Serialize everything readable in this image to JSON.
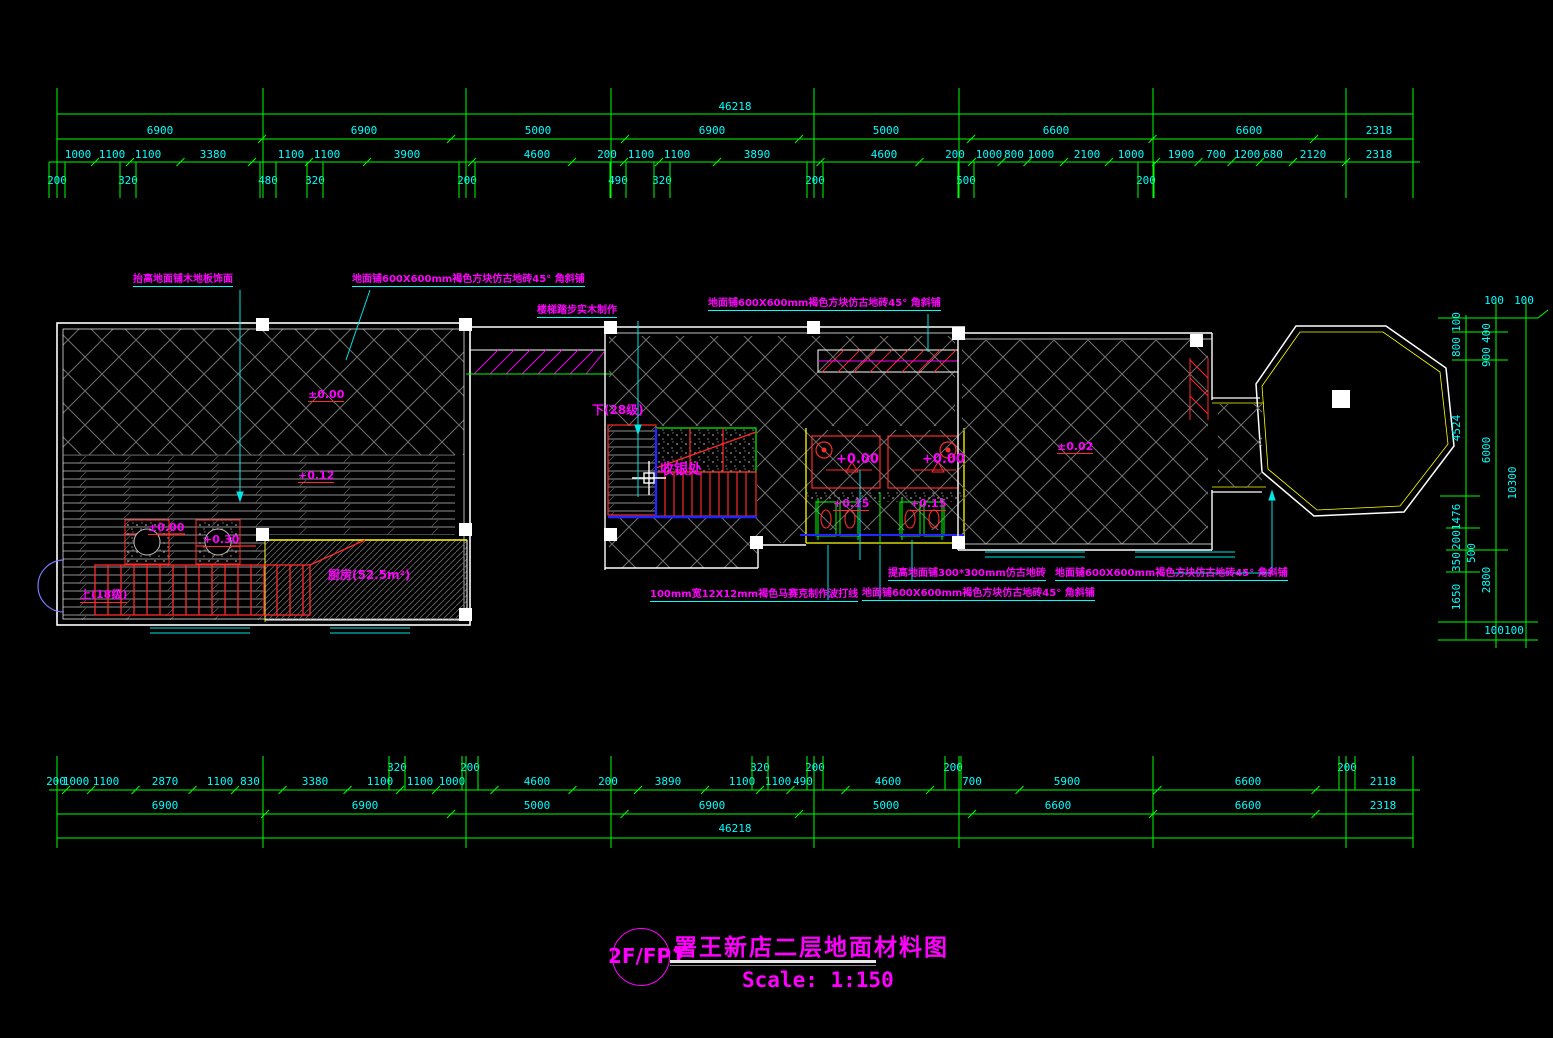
{
  "colors": {
    "background": "#000000",
    "dim_line": "#00ff00",
    "dim_text": "#00ffff",
    "annotation_text": "#ff00ff",
    "leader": "#00ffff",
    "wall": "#ffffff",
    "accent_red": "#ff0000",
    "accent_yellow": "#ffff00",
    "accent_blue": "#0000ff"
  },
  "top_dims": {
    "overall": {
      "t": "46218",
      "x": 735,
      "y": 110
    },
    "major": {
      "y": 134,
      "labels": [
        [
          "6900",
          160
        ],
        [
          "6900",
          364
        ],
        [
          "5000",
          538
        ],
        [
          "6900",
          712
        ],
        [
          "5000",
          886
        ],
        [
          "6600",
          1056
        ],
        [
          "6600",
          1249
        ],
        [
          "2318",
          1379
        ]
      ]
    },
    "detail": {
      "y": 158,
      "labels": [
        [
          "1000",
          78
        ],
        [
          "1100",
          112
        ],
        [
          "1100",
          148
        ],
        [
          "3380",
          213
        ],
        [
          "1100",
          291
        ],
        [
          "1100",
          327
        ],
        [
          "3900",
          407
        ],
        [
          "4600",
          537
        ],
        [
          "200",
          607
        ],
        [
          "1100",
          641
        ],
        [
          "1100",
          677
        ],
        [
          "3890",
          757
        ],
        [
          "4600",
          884
        ],
        [
          "200",
          955
        ],
        [
          "1000",
          989
        ],
        [
          "800",
          1014
        ],
        [
          "1000",
          1041
        ],
        [
          "2100",
          1087
        ],
        [
          "1000",
          1131
        ],
        [
          "1900",
          1181
        ],
        [
          "700",
          1216
        ],
        [
          "1200",
          1247
        ],
        [
          "680",
          1273
        ],
        [
          "2120",
          1313
        ],
        [
          "2318",
          1379
        ]
      ]
    },
    "offsets": {
      "y": 184,
      "labels": [
        [
          "200",
          57
        ],
        [
          "320",
          128
        ],
        [
          "480",
          268
        ],
        [
          "320",
          315
        ],
        [
          "200",
          467
        ],
        [
          "490",
          618
        ],
        [
          "320",
          662
        ],
        [
          "200",
          815
        ],
        [
          "500",
          966
        ],
        [
          "200",
          1146
        ]
      ]
    }
  },
  "bottom_dims": {
    "detail_raised": {
      "y": 771,
      "labels": [
        [
          "320",
          397
        ],
        [
          "200",
          470
        ],
        [
          "320",
          760
        ],
        [
          "200",
          815
        ],
        [
          "200",
          953
        ],
        [
          "200",
          1347
        ]
      ]
    },
    "detail": {
      "y": 785,
      "labels": [
        [
          "200",
          56
        ],
        [
          "1000",
          76
        ],
        [
          "1100",
          106
        ],
        [
          "2870",
          165
        ],
        [
          "1100",
          220
        ],
        [
          "830",
          250
        ],
        [
          "3380",
          315
        ],
        [
          "1100",
          380
        ],
        [
          "1100",
          420
        ],
        [
          "1000",
          452
        ],
        [
          "4600",
          537
        ],
        [
          "200",
          608
        ],
        [
          "3890",
          668
        ],
        [
          "1100",
          742
        ],
        [
          "1100",
          778
        ],
        [
          "490",
          803
        ],
        [
          "4600",
          888
        ],
        [
          "700",
          972
        ],
        [
          "5900",
          1067
        ],
        [
          "6600",
          1248
        ],
        [
          "2118",
          1383
        ]
      ]
    },
    "major": {
      "y": 809,
      "labels": [
        [
          "6900",
          165
        ],
        [
          "6900",
          365
        ],
        [
          "5000",
          537
        ],
        [
          "6900",
          712
        ],
        [
          "5000",
          886
        ],
        [
          "6600",
          1058
        ],
        [
          "6600",
          1248
        ],
        [
          "2318",
          1383
        ]
      ]
    },
    "overall": {
      "t": "46218",
      "x": 735,
      "y": 832
    }
  },
  "right_dims": {
    "col_inner": {
      "x": 1460,
      "labels": [
        [
          "100",
          322
        ],
        [
          "800",
          347
        ],
        [
          "4524",
          428
        ],
        [
          "1476",
          517
        ],
        [
          "200",
          540
        ],
        [
          "350",
          562
        ],
        [
          "1650",
          597
        ]
      ]
    },
    "col_inner2": {
      "x": 1475,
      "labels": [
        [
          "500",
          553
        ]
      ]
    },
    "col_mid": {
      "x": 1490,
      "labels": [
        [
          "400",
          333
        ],
        [
          "900",
          357
        ],
        [
          "6000",
          450
        ],
        [
          "2800",
          580
        ]
      ]
    },
    "col_outer": {
      "x": 1516,
      "labels": [
        [
          "10300",
          483
        ]
      ]
    },
    "horizontal": [
      [
        "100",
        1494,
        304
      ],
      [
        "100",
        1524,
        304
      ],
      [
        "100",
        1494,
        634
      ],
      [
        "100",
        1514,
        634
      ]
    ]
  },
  "annotations": [
    {
      "t": "抬高地面铺木地板饰面",
      "x": 133,
      "y": 270
    },
    {
      "t": "地面铺600X600mm褐色方块仿古地砖45° 角斜铺",
      "x": 352,
      "y": 270
    },
    {
      "t": "楼梯踏步实木制作",
      "x": 537,
      "y": 301
    },
    {
      "t": "地面铺600X600mm褐色方块仿古地砖45° 角斜铺",
      "x": 708,
      "y": 294
    },
    {
      "t": "100mm宽12X12mm褐色马赛克制作波打线",
      "x": 650,
      "y": 585
    },
    {
      "t": "提高地面铺300*300mm仿古地砖",
      "x": 888,
      "y": 564
    },
    {
      "t": "地面铺600X600mm褐色方块仿古地砖45° 角斜铺",
      "x": 862,
      "y": 584
    },
    {
      "t": "地面铺600X600mm褐色方块仿古地砖45° 角斜铺",
      "x": 1055,
      "y": 564
    }
  ],
  "plan_labels": [
    {
      "t": "±0.00",
      "x": 308,
      "y": 388,
      "u": 1
    },
    {
      "t": "+0.12",
      "x": 298,
      "y": 469,
      "u": 1
    },
    {
      "t": "±0.00",
      "x": 148,
      "y": 521,
      "u": 1
    },
    {
      "t": "+0.30",
      "x": 203,
      "y": 533,
      "u": 1
    },
    {
      "t": "上(18级)",
      "x": 80,
      "y": 586,
      "u": 1
    },
    {
      "t": "厨房(52.5m²)",
      "x": 328,
      "y": 566,
      "s": 12
    },
    {
      "t": "下(28级)",
      "x": 592,
      "y": 401,
      "s": 12
    },
    {
      "t": "收银处",
      "x": 660,
      "y": 459,
      "s": 14
    },
    {
      "t": "+0.00",
      "x": 836,
      "y": 452,
      "s": 13
    },
    {
      "t": "+0.00",
      "x": 922,
      "y": 452,
      "s": 13
    },
    {
      "t": "+0.15",
      "x": 833,
      "y": 497,
      "u": 1
    },
    {
      "t": "+0.15",
      "x": 910,
      "y": 497,
      "u": 1
    },
    {
      "t": "±0.02",
      "x": 1057,
      "y": 440,
      "u": 1
    }
  ],
  "title_block": {
    "tag": "2F/FP1",
    "title": "署王新店二层地面材料图",
    "scale": "Scale: 1:150"
  }
}
